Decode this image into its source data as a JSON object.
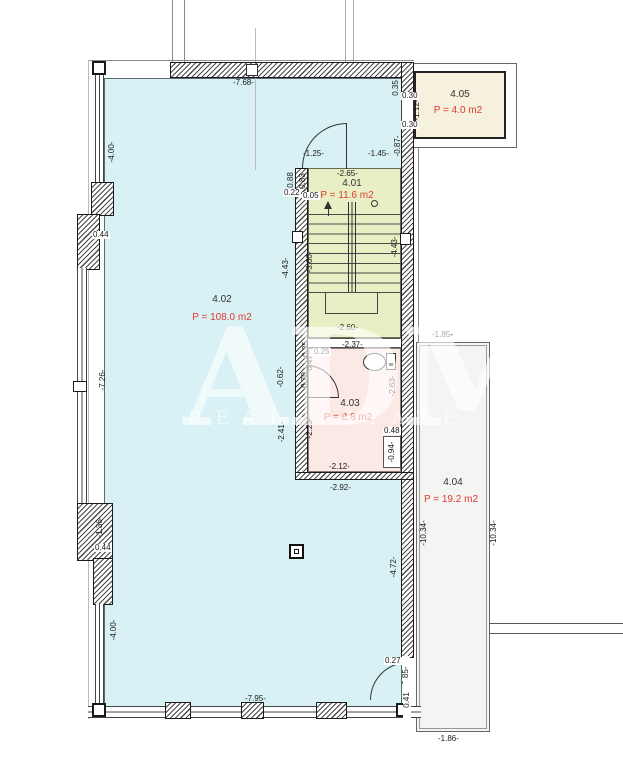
{
  "watermark": {
    "brand": "ADM",
    "tagline": "REAL ESTATE"
  },
  "rooms": {
    "r401": {
      "number": "4.01",
      "area": "P = 11.6 m2"
    },
    "r402": {
      "number": "4.02",
      "area": "P = 108.0 m2"
    },
    "r403": {
      "number": "4.03",
      "area": "P = 8.8 m2"
    },
    "r404": {
      "number": "4.04",
      "area": "P = 19.2 m2"
    },
    "r405": {
      "number": "4.05",
      "area": "P = 4.0 m2"
    }
  },
  "colors": {
    "room_402_cyan": "#d7f1f4",
    "room_401_green": "#e9efc5",
    "room_403_pink": "#fbe9e6",
    "room_405_beige": "#f6f1dd",
    "room_404_gray": "#f4f4f2",
    "area_text_red": "#e0392e"
  },
  "icons": {
    "toilet": "toilet-plan-symbol (ellipse bowl + tank rectangle)",
    "stair_direction_arrow": "up-triangle",
    "column_marker": "nested-squares"
  },
  "dims": {
    "top_width": "-7.68-",
    "stair_door_opening": "-1.25-",
    "stair_top_wall": "-1.45-",
    "stair_width_top": "-2.65-",
    "wall_022": "0.22",
    "wall_005": "0.05",
    "stair_width_bottom": "-2.60-",
    "wc_width_top": "-2.37-",
    "wc_025": "0.25",
    "wc_width_bottom": "-2.12-",
    "niche_width": "0.48",
    "below_block_width": "-2.92-",
    "terrace_width_top": "-1.85-",
    "terrace_width_bottom": "-1.86-",
    "bottom_width": "-7.95-",
    "door_br_027": "0.27",
    "left_pier_044a": "0.44",
    "left_pier_044b": "0.44",
    "opening_030a": "0.30",
    "opening_030b": "0.30",
    "left_win_400a": "-4.00-",
    "left_win_726": "-7.26-",
    "left_pier_136": "-1.36-",
    "left_win_400b": "-4.00-",
    "r405_depth_112": "-1.12-",
    "right_087": "-0.87-",
    "right_035": "0.35",
    "stair_088": "0.88",
    "stair_083": "0.83",
    "stair_depth_360": "-3.60-",
    "stair_depth_443l": "-4.43-",
    "stair_depth_443r": "-4.43-",
    "wc_door_062": "-0.62-",
    "wc_070": "0.70",
    "wc_047": "0.47",
    "wc_025v": "0.25",
    "wall_241": "-2.41-",
    "wc_depth_223": "-2.23-",
    "wc_depth_263": "-2.63-",
    "niche_depth_094": "-0.94-",
    "right_wall_472": "-4.72-",
    "terrace_depth_1034l": "-10.34-",
    "terrace_depth_1034r": "-10.34-",
    "door_br_085": "-0.85-",
    "door_br_041": "0.41"
  }
}
